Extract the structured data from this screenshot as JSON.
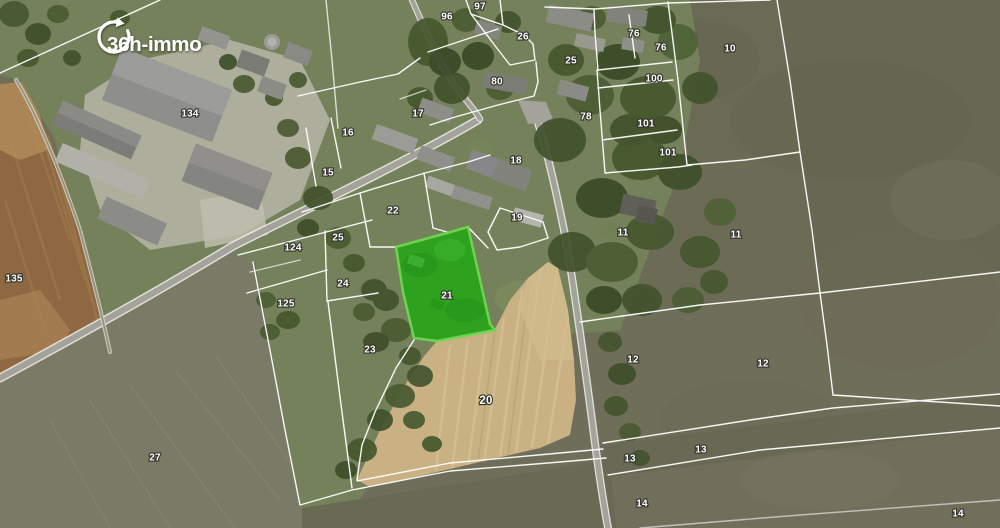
{
  "logo": {
    "text": "36h-immo"
  },
  "map": {
    "boundary_color": "#ffffff",
    "highlighted_parcel": {
      "label": "21",
      "fill": "#2ba31d",
      "stroke": "#6cd94f",
      "points": "396,247 447,233 468,227 490,324 495,330 437,341 414,338 403,292",
      "label_x": 447,
      "label_y": 296
    },
    "parcel_labels": [
      {
        "label": "134",
        "x": 190,
        "y": 114
      },
      {
        "label": "135",
        "x": 14,
        "y": 279
      },
      {
        "label": "96",
        "x": 447,
        "y": 17
      },
      {
        "label": "97",
        "x": 480,
        "y": 7
      },
      {
        "label": "26",
        "x": 523,
        "y": 37
      },
      {
        "label": "80",
        "x": 497,
        "y": 82
      },
      {
        "label": "17",
        "x": 418,
        "y": 114
      },
      {
        "label": "16",
        "x": 348,
        "y": 133
      },
      {
        "label": "15",
        "x": 328,
        "y": 173
      },
      {
        "label": "22",
        "x": 393,
        "y": 211
      },
      {
        "label": "25",
        "x": 338,
        "y": 238
      },
      {
        "label": "124",
        "x": 293,
        "y": 248
      },
      {
        "label": "24",
        "x": 343,
        "y": 284
      },
      {
        "label": "125",
        "x": 286,
        "y": 304
      },
      {
        "label": "23",
        "x": 370,
        "y": 350
      },
      {
        "label": "20",
        "x": 486,
        "y": 401,
        "size": "lg"
      },
      {
        "label": "27",
        "x": 155,
        "y": 458
      },
      {
        "label": "18",
        "x": 516,
        "y": 161
      },
      {
        "label": "19",
        "x": 517,
        "y": 218
      },
      {
        "label": "25",
        "x": 571,
        "y": 61
      },
      {
        "label": "76",
        "x": 634,
        "y": 34
      },
      {
        "label": "76",
        "x": 661,
        "y": 48
      },
      {
        "label": "100",
        "x": 654,
        "y": 79
      },
      {
        "label": "78",
        "x": 586,
        "y": 117
      },
      {
        "label": "101",
        "x": 646,
        "y": 124
      },
      {
        "label": "101",
        "x": 668,
        "y": 153
      },
      {
        "label": "10",
        "x": 730,
        "y": 49
      },
      {
        "label": "11",
        "x": 623,
        "y": 233
      },
      {
        "label": "11",
        "x": 736,
        "y": 235
      },
      {
        "label": "12",
        "x": 633,
        "y": 360
      },
      {
        "label": "12",
        "x": 763,
        "y": 364
      },
      {
        "label": "13",
        "x": 630,
        "y": 459
      },
      {
        "label": "13",
        "x": 701,
        "y": 450
      },
      {
        "label": "14",
        "x": 642,
        "y": 504
      },
      {
        "label": "14",
        "x": 958,
        "y": 514
      }
    ]
  }
}
